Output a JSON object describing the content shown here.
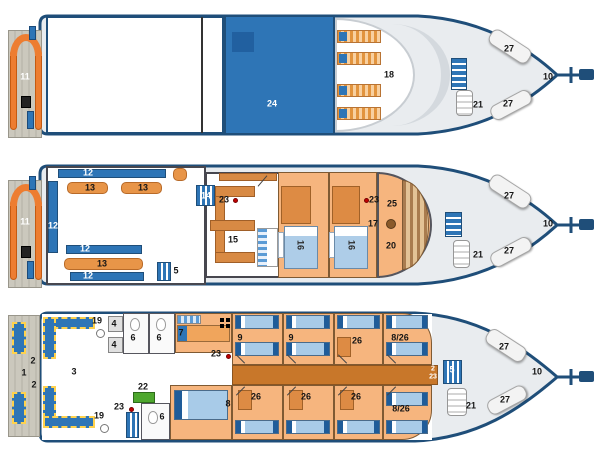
{
  "figure": "boat-deck-plans",
  "colors": {
    "hull_outline": "#1f4e79",
    "roof_blue": "#2e75b6",
    "bench_blue": "#2e75b6",
    "furniture_orange": "#ed7d31",
    "cabin_floor": "#f6b57e",
    "bed_blue": "#a8cbe8",
    "extinguisher_red": "#c00000",
    "compressor_green": "#4ea72e",
    "platform_gray": "#cbc8bd",
    "bow_deck_gray": "#e9ecef"
  },
  "icons": {
    "extinguisher-dot": "red-circle",
    "stairs-icon": "blue-striped-block",
    "ladder-icon": "white-rung-cylinder",
    "toilet-icon": "wc-bowl",
    "shower-head": "white-circle",
    "bunk-icon": "four-black-dots",
    "helm-wheel": "brown-circle"
  },
  "decks": {
    "sun_deck": {
      "stern_ladder": "11",
      "roof": "24",
      "sun_loungers": "18",
      "bow_bench_port": "27",
      "bow_bench_starboard": "27",
      "bow_ladder": "21",
      "bow": "10"
    },
    "main_deck": {
      "stern_ladder": "11",
      "bench_port": "12",
      "bench_left": "12",
      "bench_mid": "12",
      "bench_starboard": "12",
      "table_1": "13",
      "table_2": "13",
      "table_3": "13",
      "galley_stairs": "14",
      "galley_extinguisher": "23",
      "galley": "15",
      "salon_stairs": "5",
      "cabin_1": "16",
      "cabin_2": "16",
      "wheelhouse_extinguisher": "23",
      "wheelhouse_item": "25",
      "helm": "17",
      "wheelhouse_item2": "20",
      "bow_bench_port": "27",
      "bow_bench_starboard": "27",
      "bow_ladder": "21",
      "bow": "10"
    },
    "lower_deck": {
      "platform_ladder_fore": "2",
      "platform": "1",
      "platform_ladder_aft": "2",
      "dive_deck": "3",
      "shower_fore": "19",
      "shower_aft": "19",
      "locker_1": "4",
      "locker_2": "4",
      "toilet_1": "6",
      "toilet_2": "6",
      "toilet_3": "6",
      "cabin_7": "7",
      "extinguisher_fore": "23",
      "extinguisher_aft": "23",
      "cabin_9a": "9",
      "cabin_9b": "9",
      "cabin_26_top": "26",
      "cabin_826_top": "8/26",
      "compressor": "22",
      "cabin_8": "8",
      "cabin_26a": "26",
      "cabin_26b": "26",
      "cabin_26c": "26",
      "cabin_826_bottom": "8/26",
      "corridor_upper": "2",
      "corridor_lower": "23",
      "bow_stairs": "5",
      "bow_ladder": "21",
      "bow_bench_port": "27",
      "bow_bench_starboard": "27",
      "bow": "10"
    }
  }
}
